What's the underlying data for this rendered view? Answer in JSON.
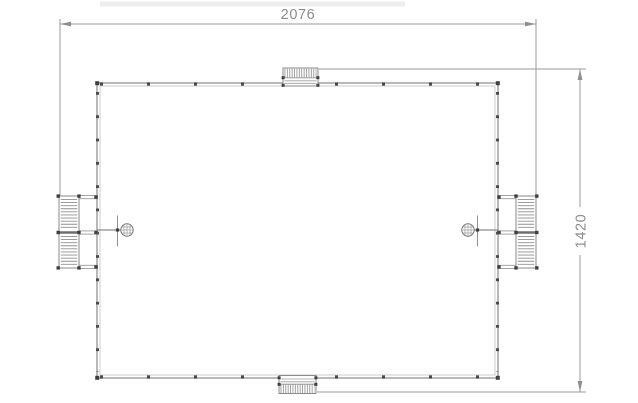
{
  "drawing": {
    "type": "technical-plan",
    "dimensions": {
      "width_label": "2076",
      "height_label": "1420"
    },
    "colors": {
      "line": "#8a8a8a",
      "line_light": "#b8b8b8",
      "post": "#3f3f3f",
      "dimension": "#9a9a9a",
      "text": "#8c8c8c",
      "background": "#ffffff",
      "artifact_strip": "#ededed"
    },
    "symbols": {
      "ladder_left": "ladder-symbol",
      "ladder_right": "ladder-symbol",
      "step_top": "entry-step-symbol",
      "step_bottom": "entry-step-symbol",
      "shower_left": "shower-head-symbol",
      "shower_right": "shower-head-symbol",
      "arrows": "dimension-arrow-icon"
    }
  }
}
